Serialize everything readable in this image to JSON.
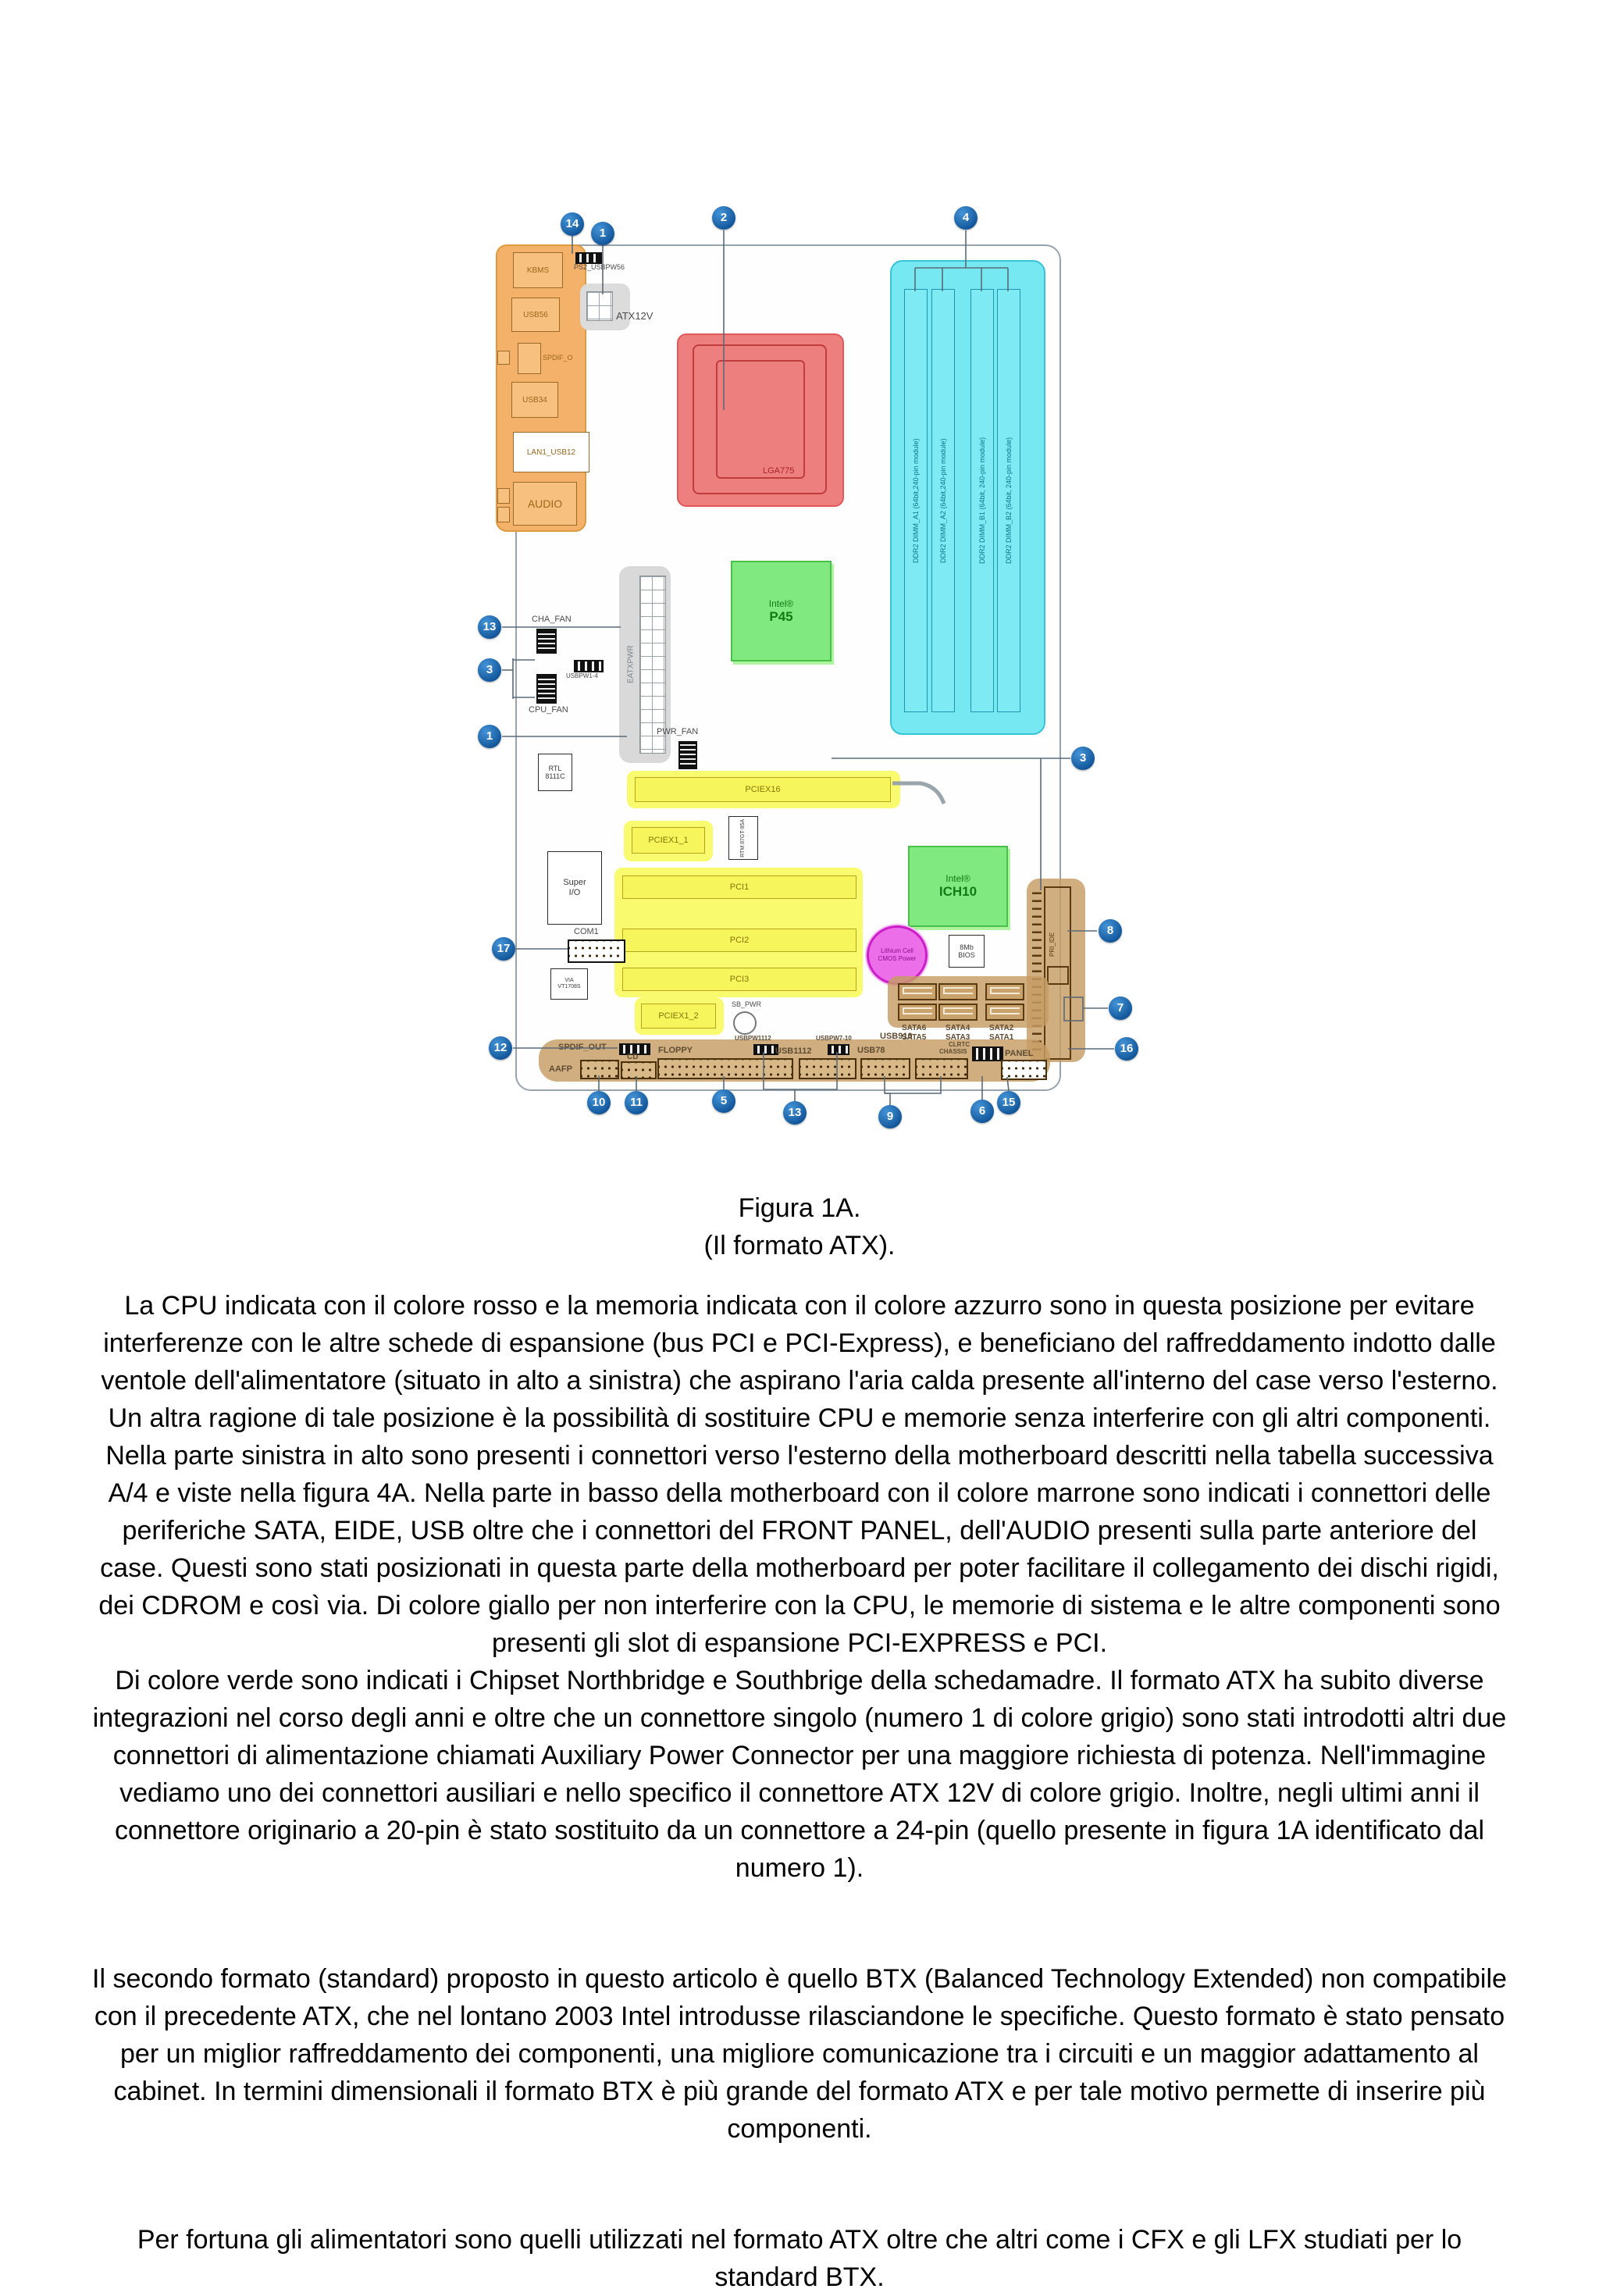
{
  "figure": {
    "callouts": [
      "14",
      "1",
      "2",
      "4",
      "13",
      "3",
      "1",
      "17",
      "12",
      "3",
      "8",
      "7",
      "16",
      "10",
      "11",
      "5",
      "13",
      "9",
      "6",
      "15"
    ],
    "io_panel": {
      "kbms": "KBMS",
      "usb56": "USB56",
      "spdif": "SPDIF_O",
      "usb34": "USB34",
      "lan": "LAN1_USB12",
      "audio": "AUDIO"
    },
    "labels": {
      "ps2_usbpw56": "PS2_USBPW56",
      "atx12v": "ATX12V",
      "lga775": "LGA775",
      "p45_brand": "Intel®",
      "p45_name": "P45",
      "ich_brand": "Intel®",
      "ich_name": "ICH10",
      "eatxpwr": "EATXPWR",
      "cha_fan": "CHA_FAN",
      "cpu_fan": "CPU_FAN",
      "pwr_fan": "PWR_FAN",
      "usbpw14": "USBPW1-4",
      "rtl_1": "RTL",
      "rtl_2": "8111C",
      "superio_1": "Super",
      "superio_2": "I/O",
      "com1": "COM1",
      "via_1": "VIA",
      "via_2": "VT1708S",
      "rtm": "RTM 87GT-95A",
      "bios_1": "8Mb",
      "bios_2": "BIOS",
      "battery_1": "Lithium Cell",
      "battery_2": "CMOS Power",
      "sb_pwr": "SB_PWR",
      "pri_ide": "PRI_IDE"
    },
    "slots": {
      "pciex16": "PCIEX16",
      "pciex1_1": "PCIEX1_1",
      "pci1": "PCI1",
      "pci2": "PCI2",
      "pci3": "PCI3",
      "pciex1_2": "PCIEX1_2"
    },
    "dimms": [
      "DDR2 DIMM_A1 (64bit,240-pin module)",
      "DDR2 DIMM_A2 (64bit,240-pin module)",
      "DDR2 DIMM_B1 (64bit, 240-pin module)",
      "DDR2 DIMM_B2 (64bit, 240-pin module)"
    ],
    "sata": [
      "SATA6",
      "SATA5",
      "SATA4",
      "SATA3",
      "SATA2",
      "SATA1"
    ],
    "bottom": {
      "spdif_out": "SPDIF_OUT",
      "cd": "CD",
      "aafp": "AAFP",
      "floppy": "FLOPPY",
      "usbpw1112": "USBPW1112",
      "usb1112": "USB1112",
      "usbpw710": "USBPW7-10",
      "usb78": "USB78",
      "usb910": "USB910",
      "clrtc": "CLRTC",
      "chassis": "CHASSIS",
      "panel": "PANEL"
    },
    "caption_line1": "Figura 1A.",
    "caption_line2": "(Il formato ATX)."
  },
  "article": {
    "paragraph1a": "La CPU indicata con il colore rosso e la memoria indicata con il colore azzurro sono in questa posizione per evitare interferenze con le altre schede di espansione (bus PCI e PCI-Express), e beneficiano del raffreddamento indotto dalle ventole dell'alimentatore (situato in alto a sinistra) che aspirano l'aria calda presente all'interno del case verso l'esterno. Un altra ragione di tale posizione è la possibilità di sostituire CPU e memorie senza interferire con gli altri componenti. Nella parte sinistra in alto sono presenti i connettori verso l'esterno della motherboard descritti nella tabella successiva A/4 e viste nella figura 4A. Nella parte in basso della motherboard con il colore marrone sono indicati i connettori delle periferiche SATA, EIDE, USB oltre che i connettori del FRONT PANEL, dell'AUDIO presenti sulla parte anteriore del case. Questi sono stati posizionati in questa parte della motherboard per poter facilitare il collegamento dei dischi rigidi, dei CDROM e così via. Di colore giallo per non interferire con la CPU, le memorie di sistema e le altre componenti sono presenti gli slot di espansione PCI-EXPRESS e PCI.",
    "paragraph1b": "Di colore verde sono indicati i Chipset Northbridge e Southbrige della schedamadre. Il formato ATX ha subito diverse integrazioni nel corso degli anni e oltre che un connettore singolo (numero 1 di colore grigio) sono stati introdotti altri due connettori di alimentazione chiamati Auxiliary Power Connector per una maggiore richiesta di potenza. Nell'immagine  vediamo uno dei connettori ausiliari e nello specifico il connettore ATX 12V di colore grigio. Inoltre, negli ultimi anni il connettore originario a 20-pin è stato sostituito da un connettore a 24-pin (quello presente in figura 1A identificato dal numero 1).",
    "paragraph2": "Il secondo formato (standard) proposto in questo articolo è quello BTX (Balanced Technology Extended) non compatibile con il precedente ATX, che nel lontano 2003 Intel introdusse rilasciandone le specifiche. Questo formato è stato pensato per un miglior raffreddamento dei componenti, una migliore comunicazione tra i circuiti e un maggior adattamento al cabinet. In termini dimensionali il formato BTX è più grande del formato ATX e per tale motivo permette di inserire più componenti.",
    "paragraph3": "Per fortuna gli alimentatori sono quelli utilizzati nel formato ATX oltre che altri come i CFX e gli LFX studiati per lo standard BTX."
  },
  "colors": {
    "cpu_red": "#ee7f7f",
    "memory_cyan": "#76e8f2",
    "chipset_green": "#80e97f",
    "slots_yellow": "#f6f65c",
    "peripherals_brown": "#c69c64",
    "io_orange": "#f4b169",
    "connector_grey": "#d9d9d9",
    "callout_blue": "#0f5296"
  }
}
